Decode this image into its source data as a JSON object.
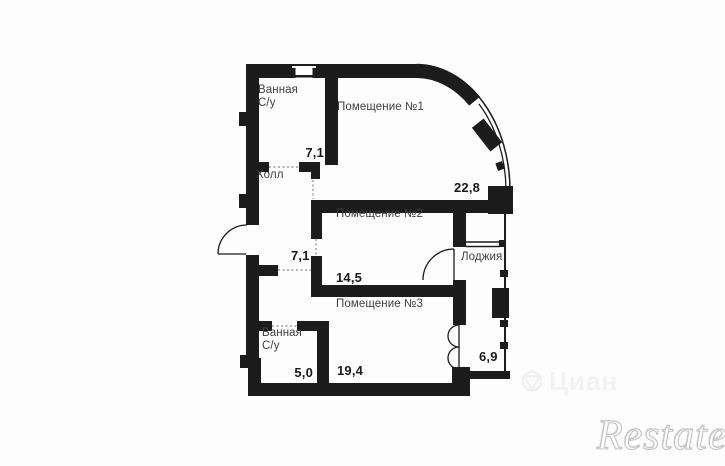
{
  "plan": {
    "type": "apartment-floor-plan",
    "rooms": [
      {
        "id": "bathroom-top",
        "name": "Ванная С/у",
        "name_lines": [
          "Ванная",
          "С/у"
        ],
        "area": "7,1"
      },
      {
        "id": "room-1",
        "name": "Помещение №1",
        "area": "22,8"
      },
      {
        "id": "hall",
        "name": "Холл",
        "area": "7,1"
      },
      {
        "id": "room-2",
        "name": "Помещение №2",
        "area": "14,5"
      },
      {
        "id": "loggia",
        "name": "Лоджия",
        "area": "6,9"
      },
      {
        "id": "room-3",
        "name": "Помещение №3",
        "area": "19,4"
      },
      {
        "id": "bathroom-bottom",
        "name": "Ванная С/у",
        "name_lines": [
          "Ванная",
          "С/у"
        ],
        "area": "5,0"
      }
    ],
    "watermarks": {
      "cian": "Циан",
      "restate": "Restate"
    },
    "colors": {
      "background": "#fdfdfd",
      "wall": "#1c1c1c",
      "label_text": "#3e3e3e",
      "area_text": "#1a1a1a",
      "dotted_opening": "#8a8a8a",
      "watermark_outline": "#c2c2c2",
      "watermark_fill": "#f2f2f2"
    }
  }
}
